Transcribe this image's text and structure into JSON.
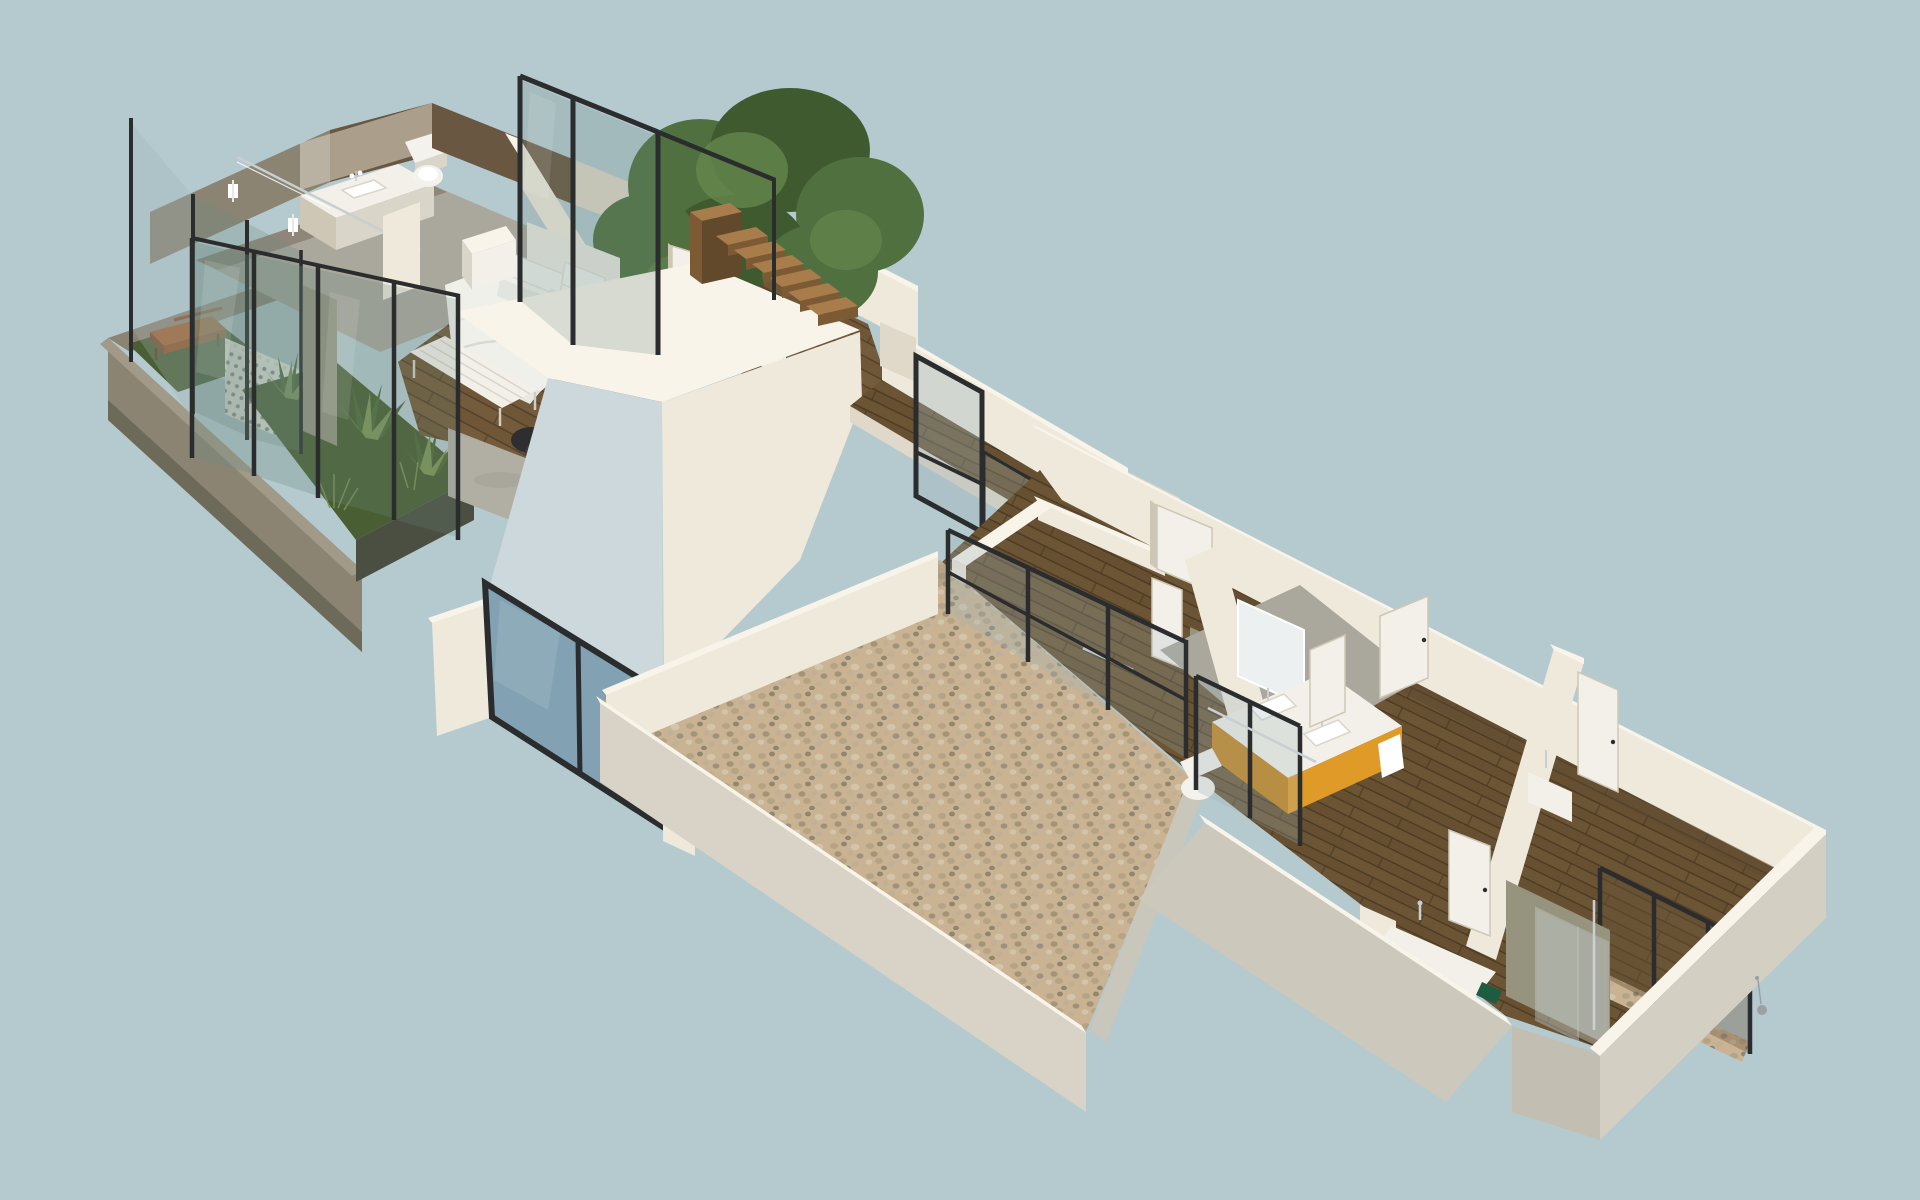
{
  "scene": {
    "title": "Isometric 3D floor plan render — two-wing residence",
    "type": "architectural-isometric-render",
    "background": "#b5cacf",
    "wings": [
      {
        "id": "master-suite-wing",
        "position": "upper-left",
        "rooms": [
          "terrace-garden",
          "master-bathroom",
          "master-bedroom",
          "tree-courtyard",
          "closet",
          "staircase",
          "hall"
        ],
        "objects": [
          "wooden-bench",
          "breeze-block-screen",
          "agave-plants",
          "glass-fence",
          "double-vanity-sink",
          "toilet",
          "shower-glass",
          "double-bed",
          "headboard",
          "pillows",
          "foot-bench",
          "cube-nightstand",
          "round-side-table",
          "tripod-lamp",
          "dark-pouf",
          "wardrobe",
          "open-door",
          "wood-stairs",
          "large-tree"
        ]
      },
      {
        "id": "bedroom-wing",
        "position": "lower-right",
        "rooms": [
          "gravel-courtyard",
          "back-corridor",
          "bedroom-1",
          "shared-bathroom",
          "bedroom-2",
          "front-washroom",
          "bedroom-3",
          "rear-bathroom"
        ],
        "objects": [
          "glass-balustrade",
          "orange-double-vanity",
          "vanity-mirror",
          "toilet",
          "shower-enclosure",
          "white-doors",
          "front-sink-counter",
          "green-accent-box",
          "window-wall-panels",
          "gravel-strip",
          "clear-shower-glass",
          "pendant-cord"
        ]
      }
    ],
    "connector": {
      "id": "hallway-bridge",
      "elements": [
        "wood-walkway",
        "parapet-wall",
        "framed-glass-panel"
      ]
    },
    "detached_elements": [
      "blue-window-panel",
      "wall-fragment"
    ]
  },
  "palette": {
    "bg": "#b5cacf",
    "wallLight": "#efe9dc",
    "wallTop": "#f8f4ea",
    "wallMid": "#e0d8c8",
    "wallShadow": "#cfc7b6",
    "wallCool": "#ccd8db",
    "concreteLight": "#c9c6bb",
    "concrete": "#aaa79d",
    "concreteDark": "#96937f",
    "planterWall": "#8b8473",
    "planterDark": "#6e6a5a",
    "planterRim": "#a29a88",
    "woodFloorA": "#6e5637",
    "woodLightA": "#7c6240",
    "woodSeamA": "#4e3d27",
    "woodFloorB": "#665031",
    "woodLightB": "#715a38",
    "woodSeamB": "#47361f",
    "stairTread": "#a87c4b",
    "stairRiser": "#7c5a34",
    "stairSide": "#63492c",
    "benchWood": "#a0602f",
    "grass": "#4a5e33",
    "grassLight": "#5a7040",
    "agaveDark": "#4f6a38",
    "agaveLight": "#7c9455",
    "treeDark": "#3f5a2f",
    "treeMid": "#507040",
    "treeLight": "#678a4e",
    "frameDark": "#2a2c2d",
    "chrome": "#c8ced1",
    "glassGreen": "#6e8a80",
    "glassCool": "#9fb4ba",
    "glassBlue": "#7f9fb1",
    "glassClear": "#cfdadd",
    "furnWhite": "#f2f0e9",
    "furnShadow": "#d9d5c9",
    "duvet": "#eff0ea",
    "orange": "#e09a28",
    "orangeDark": "#c08119",
    "gravelBase": "#c9b392",
    "stone1": "#b4a384",
    "stone2": "#a39478",
    "stone3": "#d2c5ab",
    "stone4": "#8f866f",
    "stone5": "#c0b097",
    "stone6": "#9c9180",
    "latticeHole": "#8b9188",
    "toiletWhite": "#f4f2ec",
    "greenBox": "#1d5c40",
    "darkBand": "#5d4a33",
    "pouf": "#2e2e30",
    "lampRed": "#b23c2a",
    "pendantGrey": "#9aa0a3",
    "woodPanel": "#6a5742"
  }
}
